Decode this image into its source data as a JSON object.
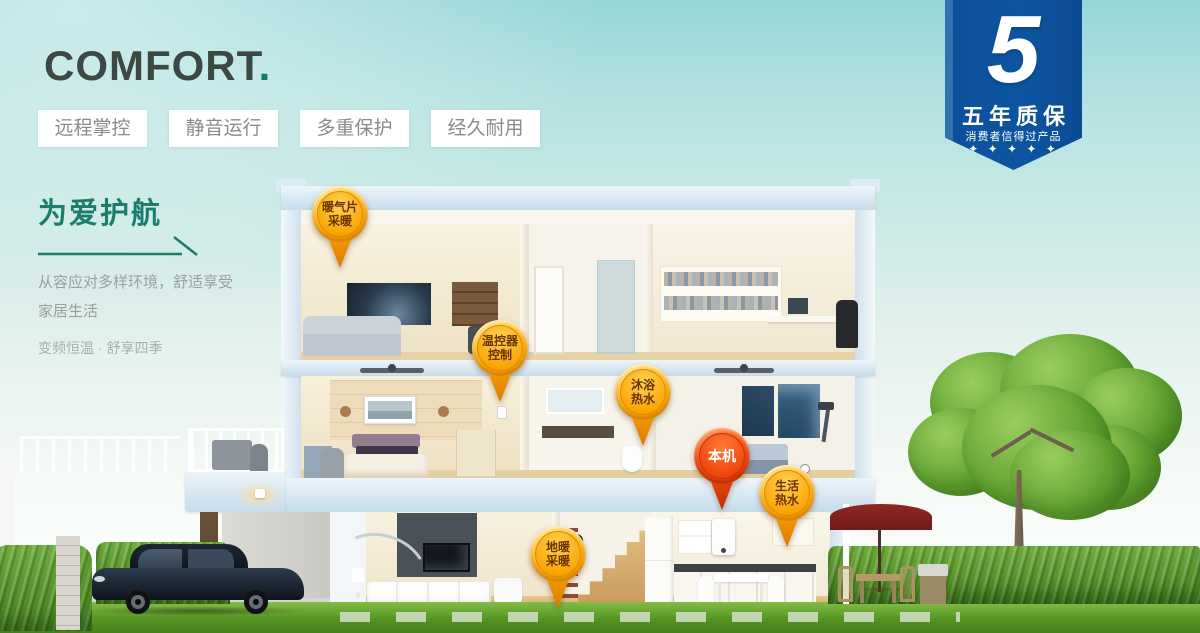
{
  "brand": {
    "title": "COMFORT",
    "dot": "."
  },
  "features": [
    {
      "label": "远程掌控"
    },
    {
      "label": "静音运行"
    },
    {
      "label": "多重保护"
    },
    {
      "label": "经久耐用"
    }
  ],
  "intro": {
    "heading": "为爱护航",
    "desc_line1": "从容应对多样环境，舒适享受",
    "desc_line2": "家居生活",
    "tagline": "变频恒温 · 舒享四季"
  },
  "warranty_badge": {
    "number": "5",
    "title": "五年质保",
    "subtitle": "消费者信得过产品",
    "stars": "✦ ✦ ✦ ✦ ✦"
  },
  "pins": [
    {
      "id": "radiator-heating",
      "line1": "暖气片",
      "line2": "采暖",
      "variant": "gold"
    },
    {
      "id": "thermostat-control",
      "line1": "温控器",
      "line2": "控制",
      "variant": "gold"
    },
    {
      "id": "bath-hot-water",
      "line1": "沐浴",
      "line2": "热水",
      "variant": "gold"
    },
    {
      "id": "main-unit",
      "line1": "本机",
      "line2": "",
      "variant": "red"
    },
    {
      "id": "domestic-hot-water",
      "line1": "生活",
      "line2": "热水",
      "variant": "gold"
    },
    {
      "id": "floor-heating",
      "line1": "地暖",
      "line2": "采暖",
      "variant": "gold"
    }
  ],
  "colors": {
    "accent_teal": "#1b7e6d",
    "badge_blue": "#0d55a0",
    "pin_gold": "#f9a800",
    "pin_red": "#e83c05",
    "sky_top": "#96d6d8",
    "grass_green": "#559423"
  }
}
